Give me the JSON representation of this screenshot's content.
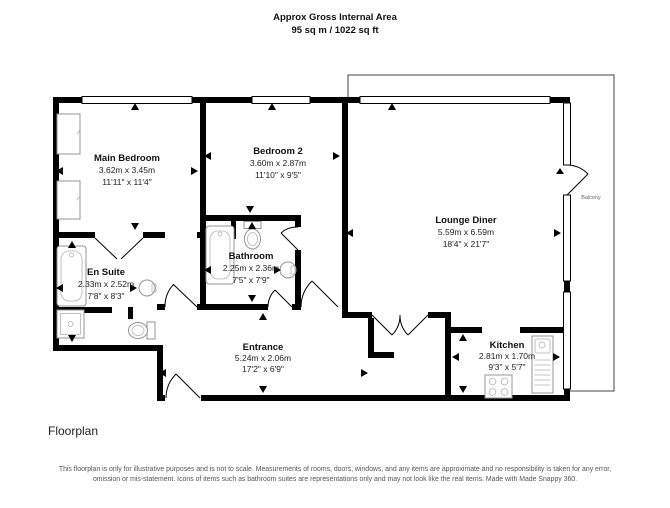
{
  "header": {
    "title": "Approx Gross Internal Area",
    "subtitle": "95 sq m / 1022 sq ft"
  },
  "rooms": [
    {
      "id": "main-bedroom",
      "name": "Main Bedroom",
      "metric": "3.62m x 3.45m",
      "imperial": "11'11\" x 11'4\""
    },
    {
      "id": "bedroom-2",
      "name": "Bedroom 2",
      "metric": "3.60m x 2.87m",
      "imperial": "11'10\" x 9'5\""
    },
    {
      "id": "lounge-diner",
      "name": "Lounge Diner",
      "metric": "5.59m x 6.59m",
      "imperial": "18'4\" x 21'7\""
    },
    {
      "id": "en-suite",
      "name": "En Suite",
      "metric": "2.33m x 2.52m",
      "imperial": "7'8\" x 8'3\""
    },
    {
      "id": "bathroom",
      "name": "Bathroom",
      "metric": "2.25m x 2.36m",
      "imperial": "7'5\" x 7'9\""
    },
    {
      "id": "entrance",
      "name": "Entrance",
      "metric": "5.24m x 2.06m",
      "imperial": "17'2\" x 6'9\""
    },
    {
      "id": "kitchen",
      "name": "Kitchen",
      "metric": "2.81m x 1.70m",
      "imperial": "9'3\" x 5'7\""
    }
  ],
  "balcony": {
    "label": "Balcony"
  },
  "footer": {
    "caption": "Floorplan",
    "disclaimer": "This floorplan is only for illustrative purposes and is not to scale. Measurements of rooms, doors, windows, and any items are approximate and no responsibility is taken for any error, omission or mis-statement. Icons of items such as bathroom suites are representations only and may not look like the real items. Made with Made Snappy 360."
  },
  "colors": {
    "wall": "#000000",
    "fixture": "#949494",
    "balcony_line": "#444444",
    "text": "#111111",
    "muted": "#555555"
  }
}
